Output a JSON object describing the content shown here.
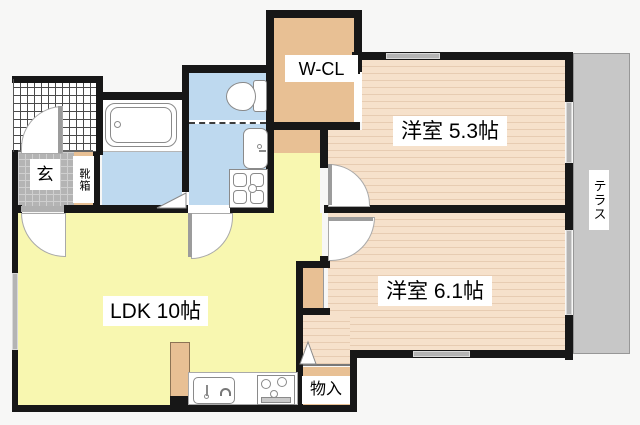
{
  "title": "apartment floor plan",
  "colors": {
    "bg": "#f7f7f6",
    "wall": "#171717",
    "floor": "#f6e1cb",
    "stripe": "#e7ccb2",
    "ldk": "#f8f7b0",
    "wet": "#bed9ef",
    "tan": "#e8c094",
    "tile": "#b4b4b4",
    "terrace": "#c7c7c7",
    "win": "#b4b4b4"
  },
  "rooms": {
    "entrance": {
      "label": "玄"
    },
    "shoe_box": {
      "label": "靴箱"
    },
    "walk_in_closet": {
      "label": "W-CL"
    },
    "western_room_53": {
      "label": "洋室 5.3帖"
    },
    "western_room_61": {
      "label": "洋室 6.1帖"
    },
    "ldk": {
      "label": "LDK 10帖"
    },
    "storage": {
      "label": "物入"
    },
    "terrace": {
      "label": "テラス"
    }
  }
}
